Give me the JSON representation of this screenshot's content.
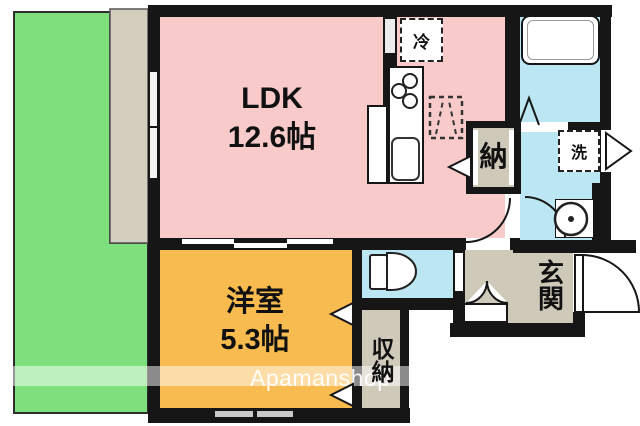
{
  "watermark": {
    "text": "Apamanshop"
  },
  "rooms": {
    "ldk": {
      "label": "LDK",
      "size": "12.6帖"
    },
    "youshitsu": {
      "label": "洋室",
      "size": "5.3帖"
    },
    "nando": {
      "label": "納"
    },
    "shuunou": {
      "label": "収納"
    },
    "genkan": {
      "label": "玄関"
    }
  },
  "fixtures": {
    "refrigerator": {
      "label": "冷"
    },
    "washer": {
      "label": "洗"
    }
  },
  "colors": {
    "garden": "#7de07d",
    "veranda": "#d3cebe",
    "ldk": "#f8caca",
    "western": "#f8bb4f",
    "water": "#bce7f2",
    "hall": "#cfc9ba",
    "closet": "#cfc9ba",
    "wall": "#161616"
  }
}
